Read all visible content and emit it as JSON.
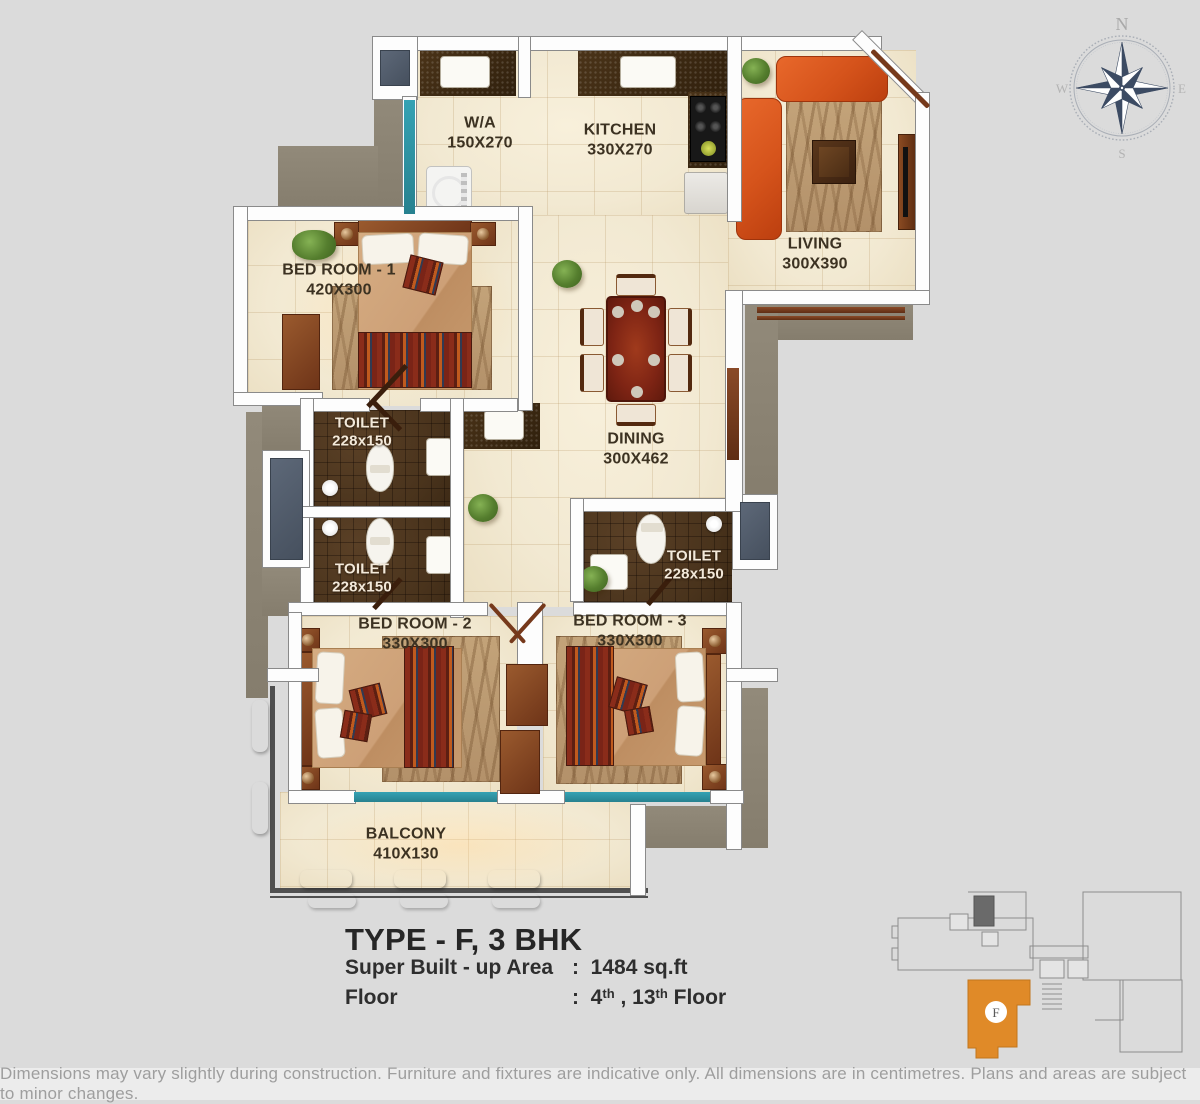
{
  "plan": {
    "rooms": [
      {
        "id": "wa",
        "name": "W/A",
        "dims": "150X270"
      },
      {
        "id": "kitchen",
        "name": "KITCHEN",
        "dims": "330X270"
      },
      {
        "id": "living",
        "name": "LIVING",
        "dims": "300X390"
      },
      {
        "id": "bedroom1",
        "name": "BED ROOM - 1",
        "dims": "420X300"
      },
      {
        "id": "toilet1",
        "name": "TOILET",
        "dims": "228x150"
      },
      {
        "id": "dining",
        "name": "DINING",
        "dims": "300X462"
      },
      {
        "id": "toilet2",
        "name": "TOILET",
        "dims": "228x150"
      },
      {
        "id": "toilet3",
        "name": "TOILET",
        "dims": "228x150"
      },
      {
        "id": "bedroom2",
        "name": "BED ROOM - 2",
        "dims": "330X300"
      },
      {
        "id": "bedroom3",
        "name": "BED ROOM - 3",
        "dims": "330X300"
      },
      {
        "id": "balcony",
        "name": "BALCONY",
        "dims": "410X130"
      }
    ]
  },
  "compass": {
    "north": "N",
    "south": "S",
    "east": "E",
    "west": "W"
  },
  "title_block": {
    "type_title": "TYPE - F, 3 BHK",
    "area_label": "Super Built - up Area",
    "area_colon": ":",
    "area_value": "1484 sq.ft",
    "floor_label": "Floor",
    "floor_colon": ":",
    "floor_num1": "4",
    "floor_sup1": "th",
    "floor_sep": " , ",
    "floor_num2": "13",
    "floor_sup2": "th",
    "floor_suffix": " Floor"
  },
  "key_plan": {
    "unit_label": "F"
  },
  "disclaimer": "Dimensions may vary slightly during construction. Furniture and fixtures are indicative only. All dimensions are in centimetres. Plans and areas are subject to minor changes.",
  "colors": {
    "page_bg": "#DBDBDB",
    "floor": "#F3EBD6",
    "wall": "#FDFDFD",
    "dark_tile": "#46311B",
    "window_teal": "#2E93A6",
    "shaft_slate": "#546070",
    "door_brown": "#7D3E1F",
    "sofa_orange": "#D95A1F",
    "exterior_band": "#8D8474",
    "keyplan_unit_orange": "#E08A28",
    "compass_navy": "#3C4B63",
    "disclaimer_text": "#9E9E9E"
  }
}
